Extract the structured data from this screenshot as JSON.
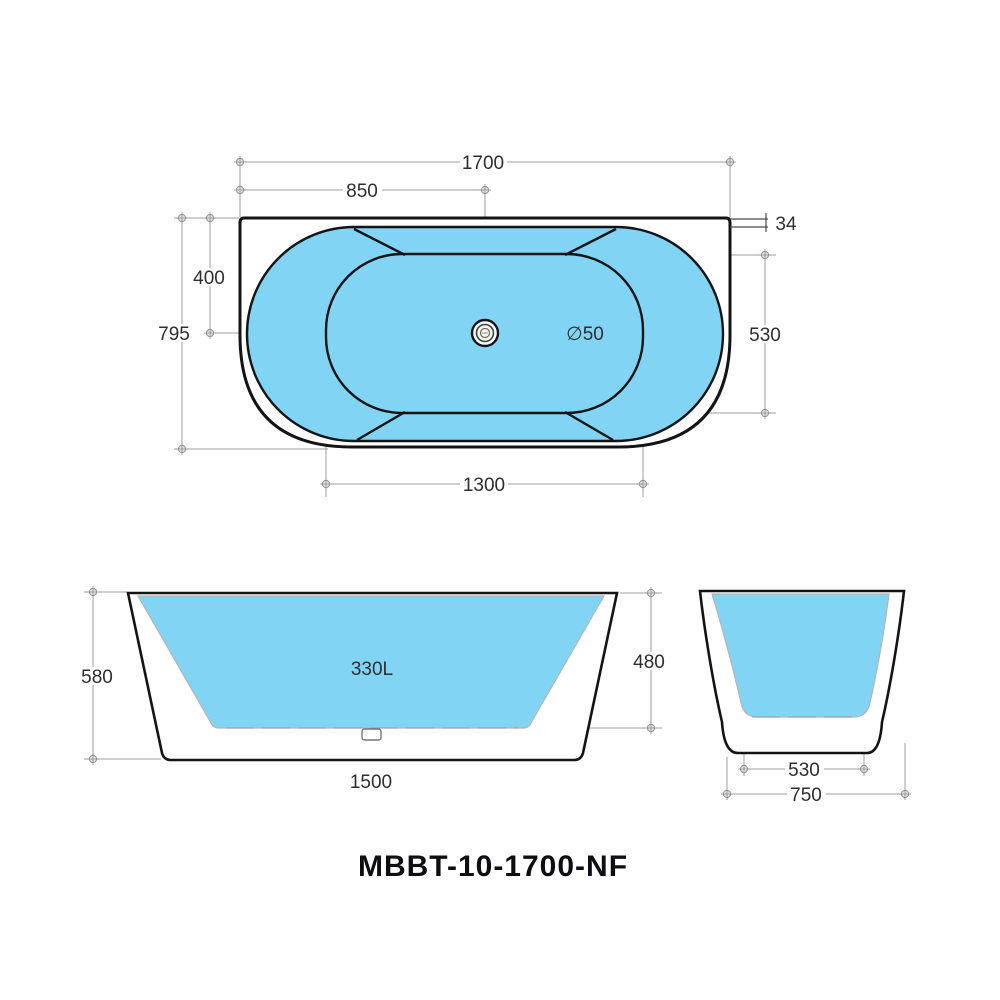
{
  "drawing": {
    "model": "MBBT-10-1700-NF",
    "colors": {
      "water": "#82d4f5",
      "outline": "#141414",
      "dim": "#9c9c9c",
      "dimtext": "#2e2e2e"
    },
    "plan": {
      "dims": {
        "overall_length": "1700",
        "center_offset": "850",
        "rim_back": "34",
        "overall_width": "795",
        "drain_offset": "400",
        "inner_width": "530",
        "inner_length": "1300",
        "drain_diameter": "∅50"
      }
    },
    "front": {
      "capacity": "330L",
      "dims": {
        "overall_height": "580",
        "inner_depth": "480",
        "base_length": "1500"
      }
    },
    "side": {
      "dims": {
        "inner_base_width": "530",
        "base_width": "750"
      }
    }
  }
}
